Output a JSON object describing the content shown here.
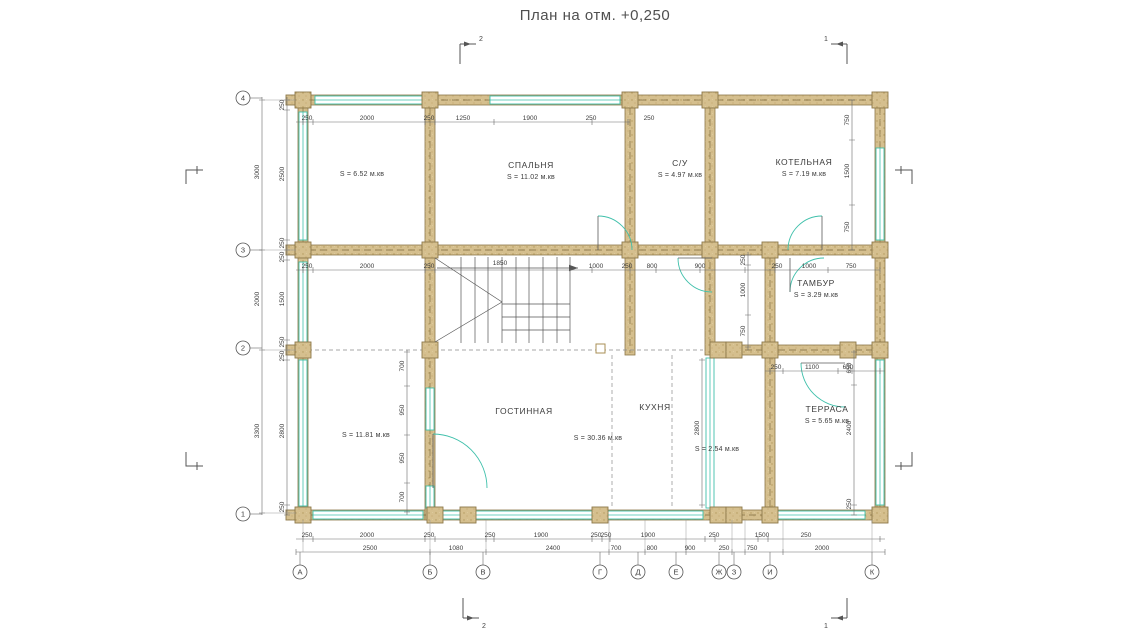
{
  "title": "План на отм. +0,250",
  "colors": {
    "wall": "#d5bf8e",
    "wall_stroke": "#8d784a",
    "window": "#3fc0ab",
    "text": "#3c3c3c"
  },
  "plan": {
    "rooms": [
      {
        "name": "",
        "area": "S = 6.52 м.кв",
        "x": 362,
        "y": 176
      },
      {
        "name": "СПАЛЬНЯ",
        "area": "S = 11.02 м.кв",
        "x": 531,
        "y": 168
      },
      {
        "name": "С/У",
        "area": "S = 4.97 м.кв",
        "x": 680,
        "y": 166
      },
      {
        "name": "КОТЕЛЬНАЯ",
        "area": "S = 7.19 м.кв",
        "x": 804,
        "y": 165
      },
      {
        "name": "ТАМБУР",
        "area": "S = 3.29 м.кв",
        "x": 816,
        "y": 286
      },
      {
        "name": "",
        "area": "S = 11.81 м.кв",
        "x": 366,
        "y": 437
      },
      {
        "name": "ГОСТИННАЯ",
        "area": "",
        "x": 524,
        "y": 414
      },
      {
        "name": "",
        "area": "S = 30.36 м.кв",
        "x": 598,
        "y": 440
      },
      {
        "name": "КУХНЯ",
        "area": "",
        "x": 655,
        "y": 410
      },
      {
        "name": "",
        "area": "S = 2.54 м.кв",
        "x": 717,
        "y": 451
      },
      {
        "name": "ТЕРРАСА",
        "area": "S = 5.65 м.кв",
        "x": 827,
        "y": 412
      }
    ],
    "dims": [
      [
        "250",
        307,
        120,
        0
      ],
      [
        "2000",
        367,
        120,
        0
      ],
      [
        "250",
        429,
        120,
        0
      ],
      [
        "1250",
        463,
        120,
        0
      ],
      [
        "1900",
        530,
        120,
        0
      ],
      [
        "250",
        591,
        120,
        0
      ],
      [
        "250",
        649,
        120,
        0
      ],
      [
        "250",
        307,
        268,
        0
      ],
      [
        "2000",
        367,
        268,
        0
      ],
      [
        "250",
        429,
        268,
        0
      ],
      [
        "1000",
        596,
        268,
        0
      ],
      [
        "250",
        627,
        268,
        0
      ],
      [
        "800",
        652,
        268,
        0
      ],
      [
        "900",
        700,
        268,
        0
      ],
      [
        "250",
        777,
        268,
        0
      ],
      [
        "1000",
        809,
        268,
        0
      ],
      [
        "750",
        851,
        268,
        0
      ],
      [
        "1850",
        500,
        265,
        0
      ],
      [
        "250",
        307,
        537,
        0
      ],
      [
        "2000",
        367,
        537,
        0
      ],
      [
        "250",
        429,
        537,
        0
      ],
      [
        "250",
        490,
        537,
        0
      ],
      [
        "1900",
        541,
        537,
        0
      ],
      [
        "250",
        596,
        537,
        0
      ],
      [
        "250",
        606,
        537,
        0
      ],
      [
        "1900",
        648,
        537,
        0
      ],
      [
        "250",
        714,
        537,
        0
      ],
      [
        "1500",
        762,
        537,
        0
      ],
      [
        "250",
        806,
        537,
        0
      ],
      [
        "2500",
        370,
        550,
        0
      ],
      [
        "1080",
        456,
        550,
        0
      ],
      [
        "2400",
        553,
        550,
        0
      ],
      [
        "700",
        616,
        550,
        0
      ],
      [
        "800",
        652,
        550,
        0
      ],
      [
        "900",
        690,
        550,
        0
      ],
      [
        "250",
        724,
        550,
        0
      ],
      [
        "750",
        752,
        550,
        0
      ],
      [
        "2000",
        822,
        550,
        0
      ],
      [
        "250",
        776,
        369,
        0
      ],
      [
        "1100",
        812,
        369,
        0
      ],
      [
        "650",
        848,
        369,
        0
      ],
      [
        "3000",
        259,
        172,
        1
      ],
      [
        "2000",
        259,
        299,
        1
      ],
      [
        "3300",
        259,
        431,
        1
      ],
      [
        "250",
        284,
        105,
        1
      ],
      [
        "2500",
        284,
        174,
        1
      ],
      [
        "250",
        284,
        243,
        1
      ],
      [
        "250",
        284,
        257,
        1
      ],
      [
        "1500",
        284,
        299,
        1
      ],
      [
        "250",
        284,
        342,
        1
      ],
      [
        "250",
        284,
        356,
        1
      ],
      [
        "2800",
        284,
        431,
        1
      ],
      [
        "250",
        284,
        507,
        1
      ],
      [
        "750",
        849,
        120,
        1
      ],
      [
        "1500",
        849,
        171,
        1
      ],
      [
        "750",
        849,
        227,
        1
      ],
      [
        "250",
        745,
        260,
        1
      ],
      [
        "1000",
        745,
        290,
        1
      ],
      [
        "750",
        745,
        331,
        1
      ],
      [
        "650",
        851,
        368,
        1
      ],
      [
        "2400",
        851,
        428,
        1
      ],
      [
        "250",
        851,
        504,
        1
      ],
      [
        "700",
        404,
        366,
        1
      ],
      [
        "950",
        404,
        410,
        1
      ],
      [
        "950",
        404,
        458,
        1
      ],
      [
        "700",
        404,
        497,
        1
      ],
      [
        "2800",
        699,
        428,
        1
      ]
    ],
    "axes_bottom": [
      {
        "label": "А",
        "x": 300
      },
      {
        "label": "Б",
        "x": 430
      },
      {
        "label": "В",
        "x": 483
      },
      {
        "label": "Г",
        "x": 600
      },
      {
        "label": "Д",
        "x": 638
      },
      {
        "label": "Е",
        "x": 676
      },
      {
        "label": "Ж",
        "x": 719
      },
      {
        "label": "З",
        "x": 734
      },
      {
        "label": "И",
        "x": 770
      },
      {
        "label": "К",
        "x": 872
      }
    ],
    "axes_left": [
      {
        "label": "4",
        "y": 98
      },
      {
        "label": "3",
        "y": 250
      },
      {
        "label": "2",
        "y": 348
      },
      {
        "label": "1",
        "y": 514
      }
    ],
    "sections": [
      {
        "label": "2",
        "x": 460,
        "y": 44,
        "dir": 1,
        "side": "top"
      },
      {
        "label": "1",
        "x": 847,
        "y": 44,
        "dir": -1,
        "side": "top"
      },
      {
        "label": "2",
        "x": 463,
        "y": 618,
        "dir": 1,
        "side": "bottom"
      },
      {
        "label": "1",
        "x": 847,
        "y": 618,
        "dir": -1,
        "side": "bottom"
      }
    ]
  }
}
